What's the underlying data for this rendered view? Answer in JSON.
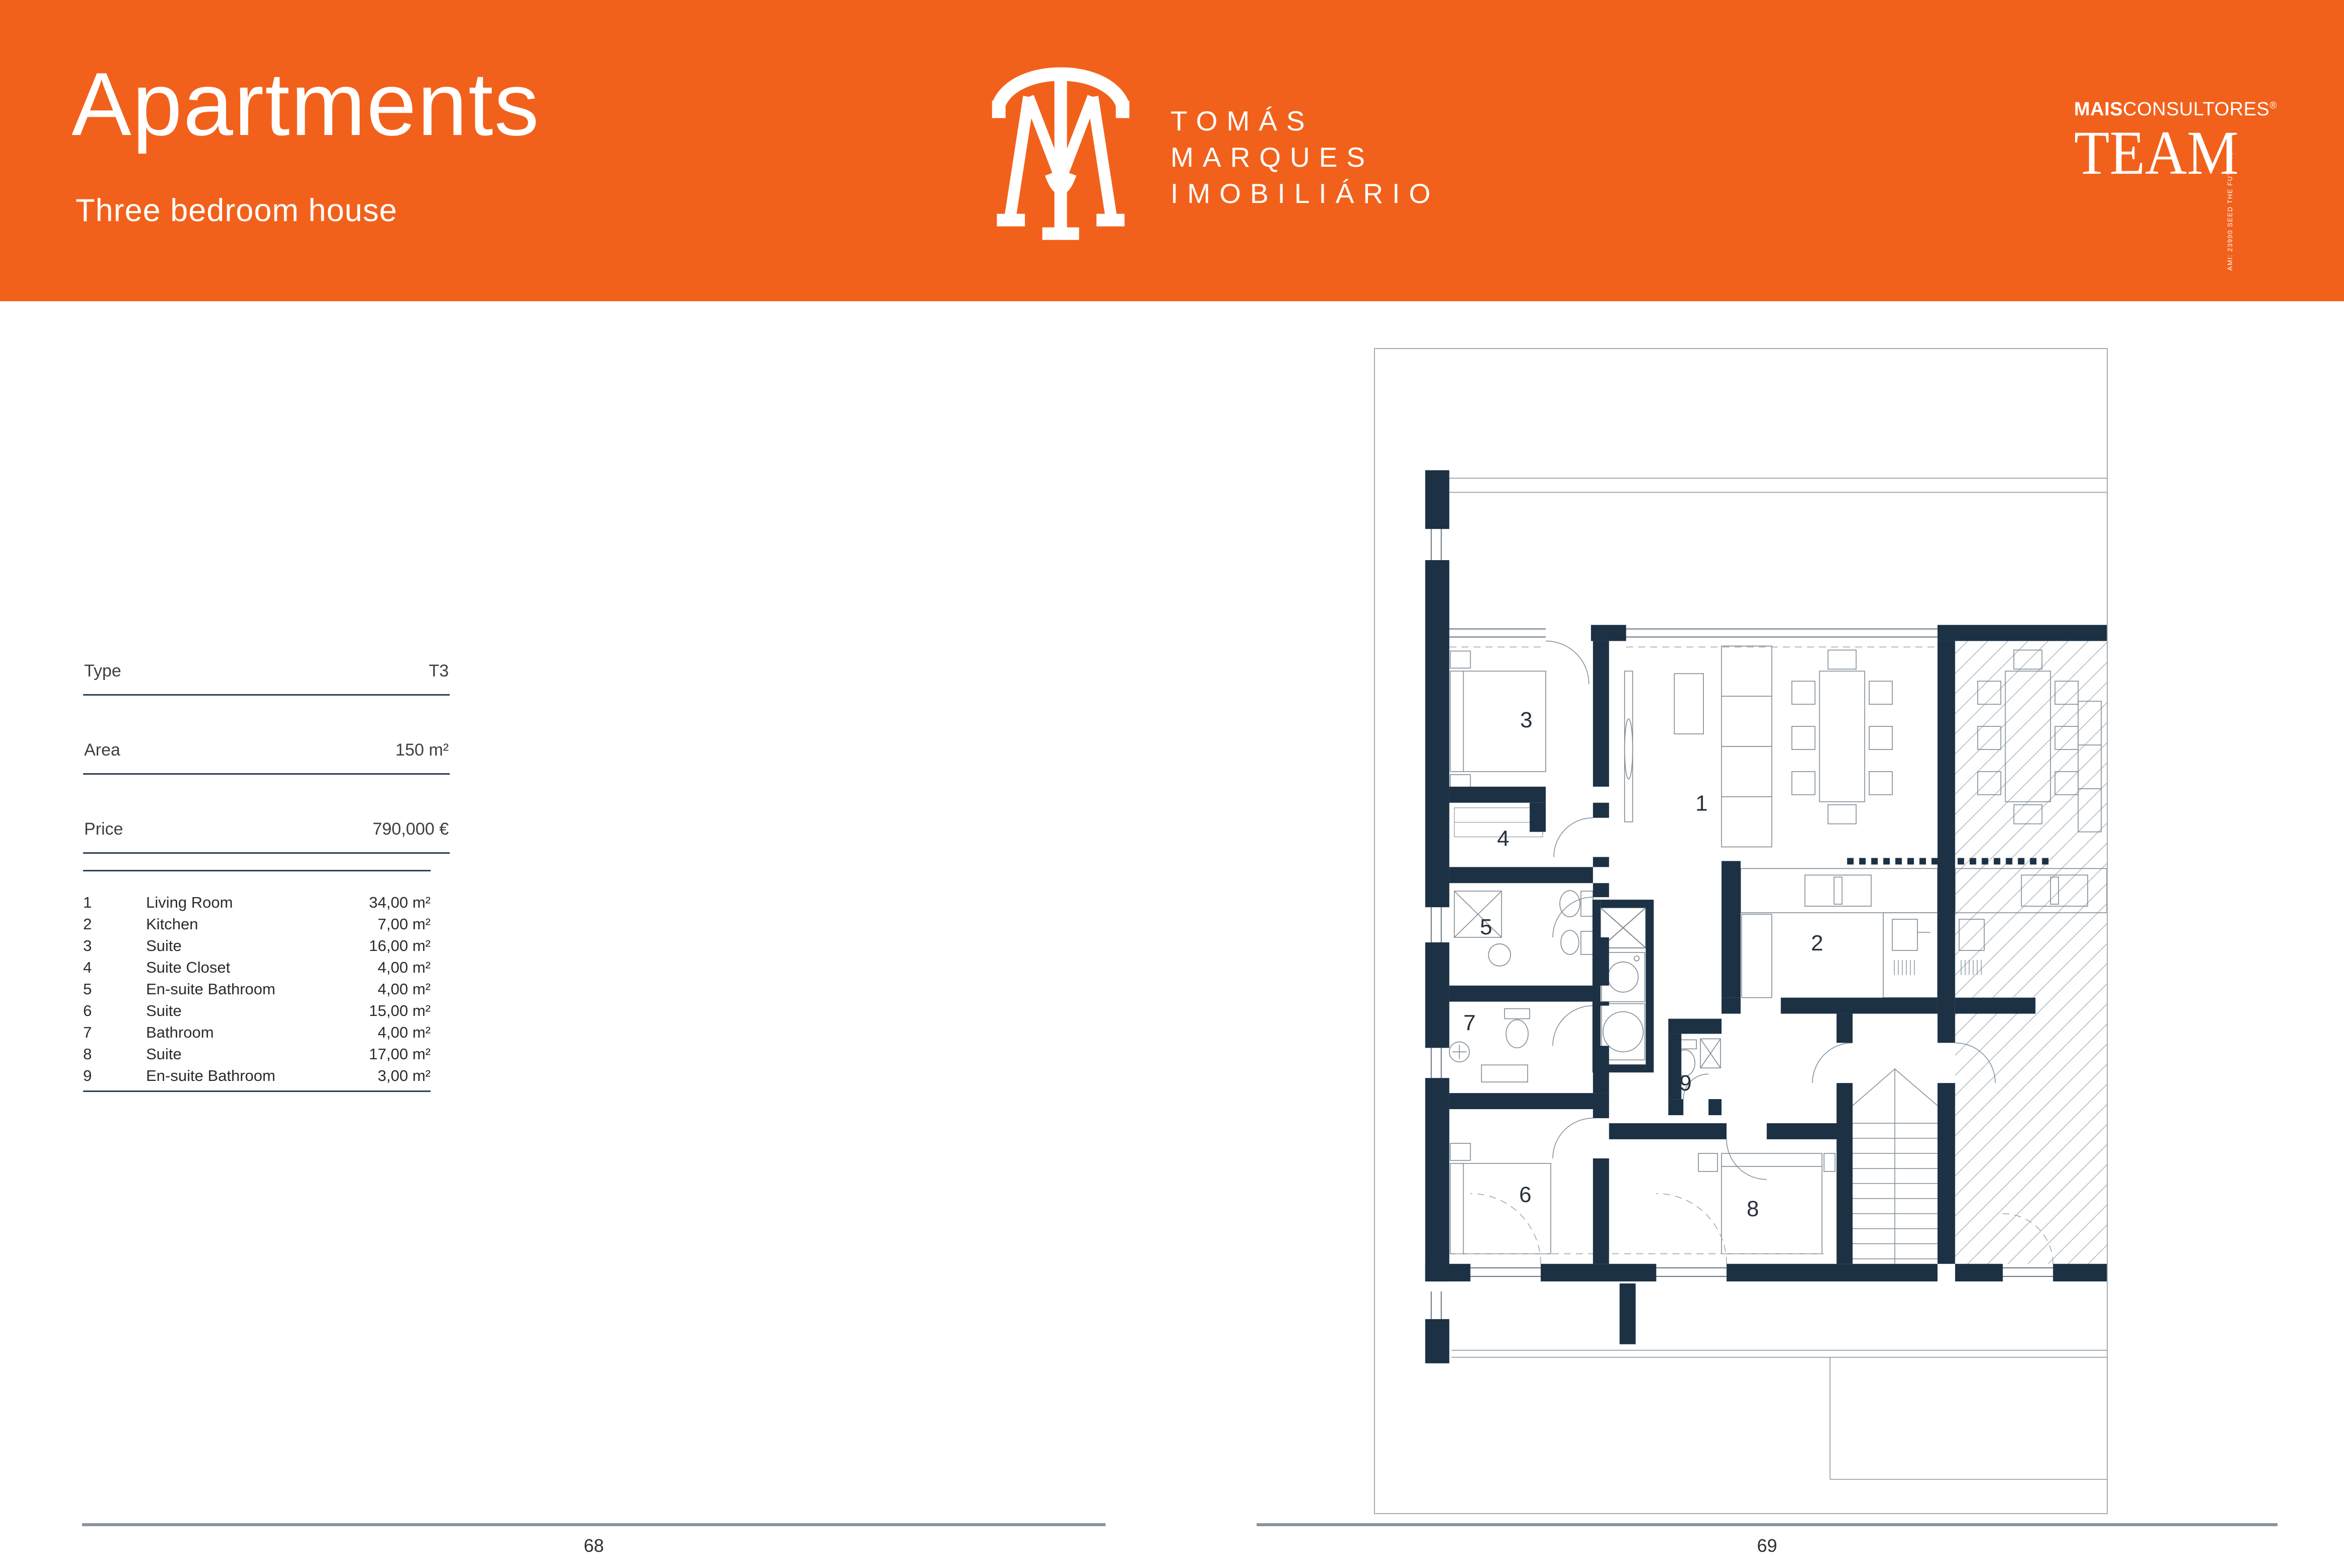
{
  "header": {
    "title": "Apartments",
    "subtitle": "Three bedroom house",
    "brand_line1": "TOMÁS",
    "brand_line2": "MARQUES",
    "brand_line3": "IMOBILIÁRIO",
    "partner_bold": "MAIS",
    "partner_rest": "CONSULTORES",
    "partner_reg": "®",
    "partner_wordmark": "TEAM",
    "partner_side": "AMI: 23990  SEED THE FUTURE, LDA."
  },
  "details": {
    "rows": [
      {
        "label": "Type",
        "value": "T3"
      },
      {
        "label": "Area",
        "value": "150 m²"
      },
      {
        "label": "Price",
        "value": "790,000 €"
      }
    ]
  },
  "rooms": {
    "items": [
      {
        "num": "1",
        "name": "Living Room",
        "area": "34,00 m²"
      },
      {
        "num": "2",
        "name": "Kitchen",
        "area": "7,00 m²"
      },
      {
        "num": "3",
        "name": "Suite",
        "area": "16,00 m²"
      },
      {
        "num": "4",
        "name": "Suite Closet",
        "area": "4,00 m²"
      },
      {
        "num": "5",
        "name": "En-suite Bathroom",
        "area": "4,00 m²"
      },
      {
        "num": "6",
        "name": "Suite",
        "area": "15,00 m²"
      },
      {
        "num": "7",
        "name": "Bathroom",
        "area": "4,00 m²"
      },
      {
        "num": "8",
        "name": "Suite",
        "area": "17,00 m²"
      },
      {
        "num": "9",
        "name": "En-suite Bathroom",
        "area": "3,00 m²"
      }
    ]
  },
  "plan": {
    "labels": [
      "1",
      "2",
      "3",
      "4",
      "5",
      "6",
      "7",
      "8",
      "9"
    ]
  },
  "footer": {
    "left_page": "68",
    "right_page": "69"
  },
  "colors": {
    "accent": "#F2611B",
    "wall": "#1C3144",
    "rule": "#2B3E52",
    "footer_line": "#8A939B"
  }
}
